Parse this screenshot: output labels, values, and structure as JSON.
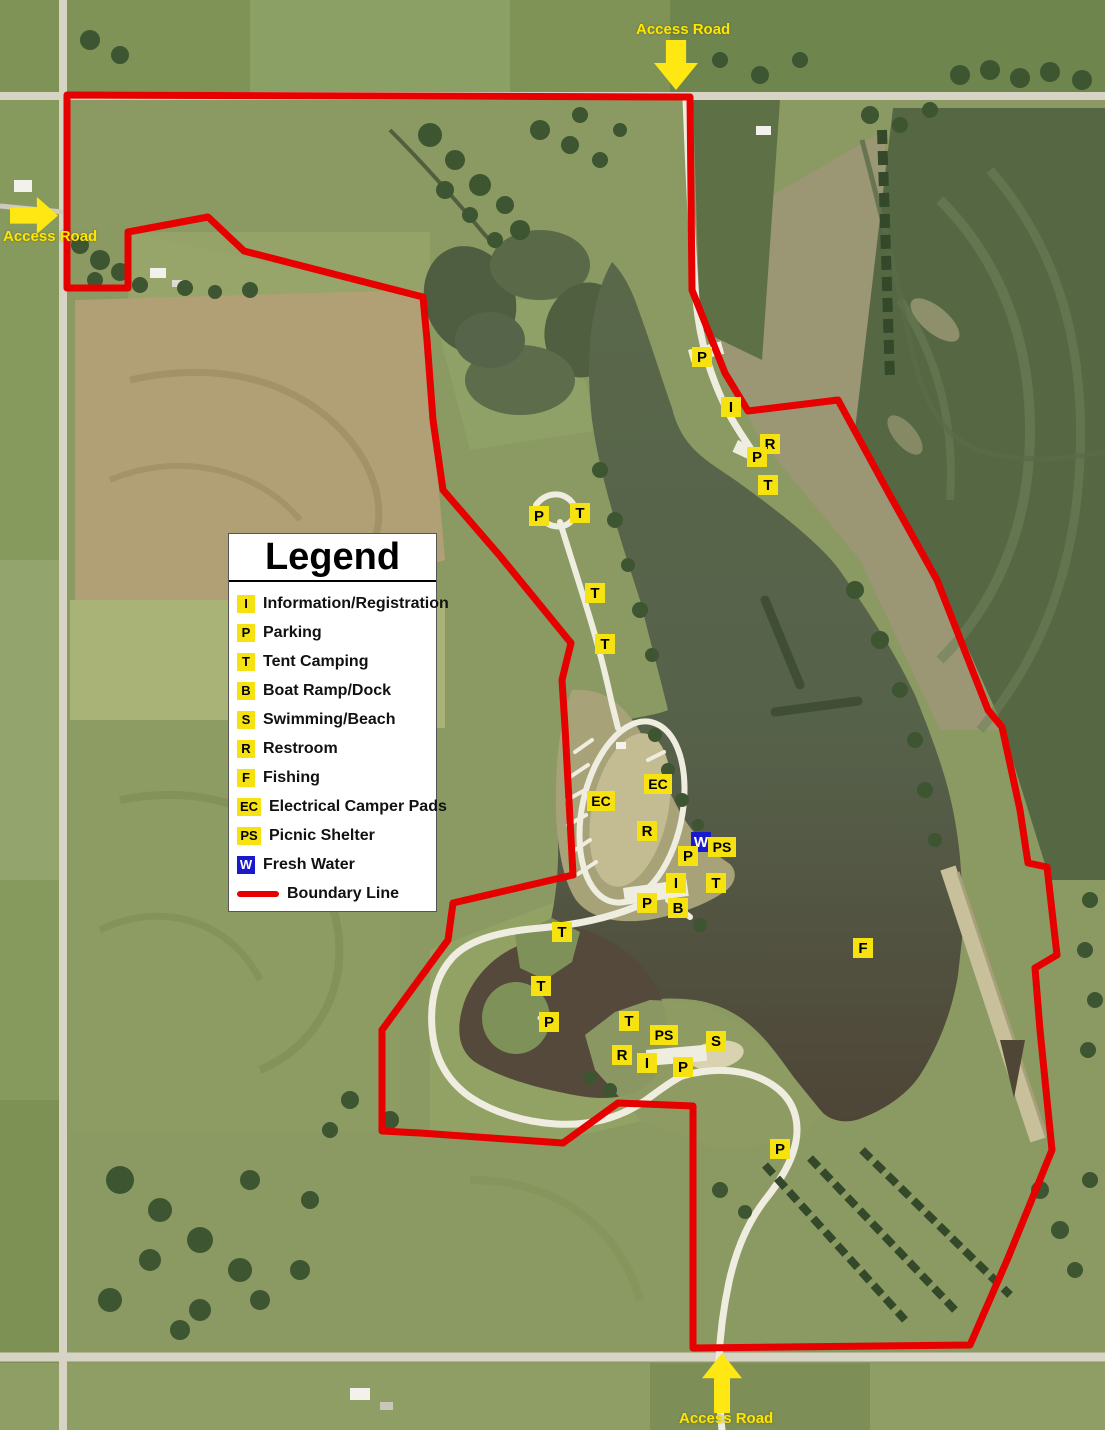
{
  "legend": {
    "title": "Legend",
    "items": [
      {
        "symbol": "I",
        "label": "Information/Registration",
        "kind": "box",
        "bg": "#f7e211",
        "fg": "#000000"
      },
      {
        "symbol": "P",
        "label": "Parking",
        "kind": "box",
        "bg": "#f7e211",
        "fg": "#000000"
      },
      {
        "symbol": "T",
        "label": "Tent Camping",
        "kind": "box",
        "bg": "#f7e211",
        "fg": "#000000"
      },
      {
        "symbol": "B",
        "label": "Boat Ramp/Dock",
        "kind": "box",
        "bg": "#f7e211",
        "fg": "#000000"
      },
      {
        "symbol": "S",
        "label": "Swimming/Beach",
        "kind": "box",
        "bg": "#f7e211",
        "fg": "#000000"
      },
      {
        "symbol": "R",
        "label": "Restroom",
        "kind": "box",
        "bg": "#f7e211",
        "fg": "#000000"
      },
      {
        "symbol": "F",
        "label": "Fishing",
        "kind": "box",
        "bg": "#f7e211",
        "fg": "#000000"
      },
      {
        "symbol": "EC",
        "label": "Electrical Camper Pads",
        "kind": "box",
        "bg": "#f7e211",
        "fg": "#000000"
      },
      {
        "symbol": "PS",
        "label": "Picnic Shelter",
        "kind": "box",
        "bg": "#f7e211",
        "fg": "#000000"
      },
      {
        "symbol": "W",
        "label": "Fresh Water",
        "kind": "box",
        "bg": "#1a1acc",
        "fg": "#ffffff"
      },
      {
        "symbol": "",
        "label": "Boundary Line",
        "kind": "line",
        "bg": "#e60000",
        "fg": "#e60000"
      }
    ]
  },
  "access_roads": [
    {
      "label": "Access Road",
      "position": "top",
      "arrow": "down"
    },
    {
      "label": "Access Road",
      "position": "left",
      "arrow": "right"
    },
    {
      "label": "Access Road",
      "position": "bottom",
      "arrow": "up"
    }
  ],
  "map": {
    "markers": [
      {
        "symbol": "P",
        "type": "parking",
        "x": 702,
        "y": 357
      },
      {
        "symbol": "I",
        "type": "information",
        "x": 731,
        "y": 407
      },
      {
        "symbol": "R",
        "type": "restroom",
        "x": 770,
        "y": 444
      },
      {
        "symbol": "P",
        "type": "parking",
        "x": 757,
        "y": 457
      },
      {
        "symbol": "T",
        "type": "tent-camping",
        "x": 768,
        "y": 485
      },
      {
        "symbol": "P",
        "type": "parking",
        "x": 539,
        "y": 516
      },
      {
        "symbol": "T",
        "type": "tent-camping",
        "x": 580,
        "y": 513
      },
      {
        "symbol": "T",
        "type": "tent-camping",
        "x": 595,
        "y": 593
      },
      {
        "symbol": "T",
        "type": "tent-camping",
        "x": 605,
        "y": 644
      },
      {
        "symbol": "EC",
        "type": "electrical-camper-pads",
        "x": 658,
        "y": 784
      },
      {
        "symbol": "EC",
        "type": "electrical-camper-pads",
        "x": 601,
        "y": 801
      },
      {
        "symbol": "R",
        "type": "restroom",
        "x": 647,
        "y": 831
      },
      {
        "symbol": "W",
        "type": "fresh-water",
        "x": 701,
        "y": 842
      },
      {
        "symbol": "PS",
        "type": "picnic-shelter",
        "x": 722,
        "y": 847
      },
      {
        "symbol": "P",
        "type": "parking",
        "x": 688,
        "y": 856
      },
      {
        "symbol": "I",
        "type": "information",
        "x": 676,
        "y": 883
      },
      {
        "symbol": "T",
        "type": "tent-camping",
        "x": 716,
        "y": 883
      },
      {
        "symbol": "P",
        "type": "parking",
        "x": 647,
        "y": 903
      },
      {
        "symbol": "B",
        "type": "boat-ramp-dock",
        "x": 678,
        "y": 908
      },
      {
        "symbol": "T",
        "type": "tent-camping",
        "x": 562,
        "y": 932
      },
      {
        "symbol": "T",
        "type": "tent-camping",
        "x": 541,
        "y": 986
      },
      {
        "symbol": "P",
        "type": "parking",
        "x": 549,
        "y": 1022
      },
      {
        "symbol": "T",
        "type": "tent-camping",
        "x": 629,
        "y": 1021
      },
      {
        "symbol": "PS",
        "type": "picnic-shelter",
        "x": 664,
        "y": 1035
      },
      {
        "symbol": "S",
        "type": "swimming-beach",
        "x": 716,
        "y": 1041
      },
      {
        "symbol": "R",
        "type": "restroom",
        "x": 622,
        "y": 1055
      },
      {
        "symbol": "I",
        "type": "information",
        "x": 647,
        "y": 1063
      },
      {
        "symbol": "P",
        "type": "parking",
        "x": 683,
        "y": 1067
      },
      {
        "symbol": "F",
        "type": "fishing",
        "x": 863,
        "y": 948
      },
      {
        "symbol": "P",
        "type": "parking",
        "x": 780,
        "y": 1149
      }
    ]
  },
  "colors": {
    "boundary_red": "#e60000",
    "marker_yellow": "#f7e211",
    "fresh_water_blue": "#1a1acc",
    "access_road_yellow": "#ffe600",
    "lake_water": "#57624a",
    "legend_background": "#ffffff"
  }
}
